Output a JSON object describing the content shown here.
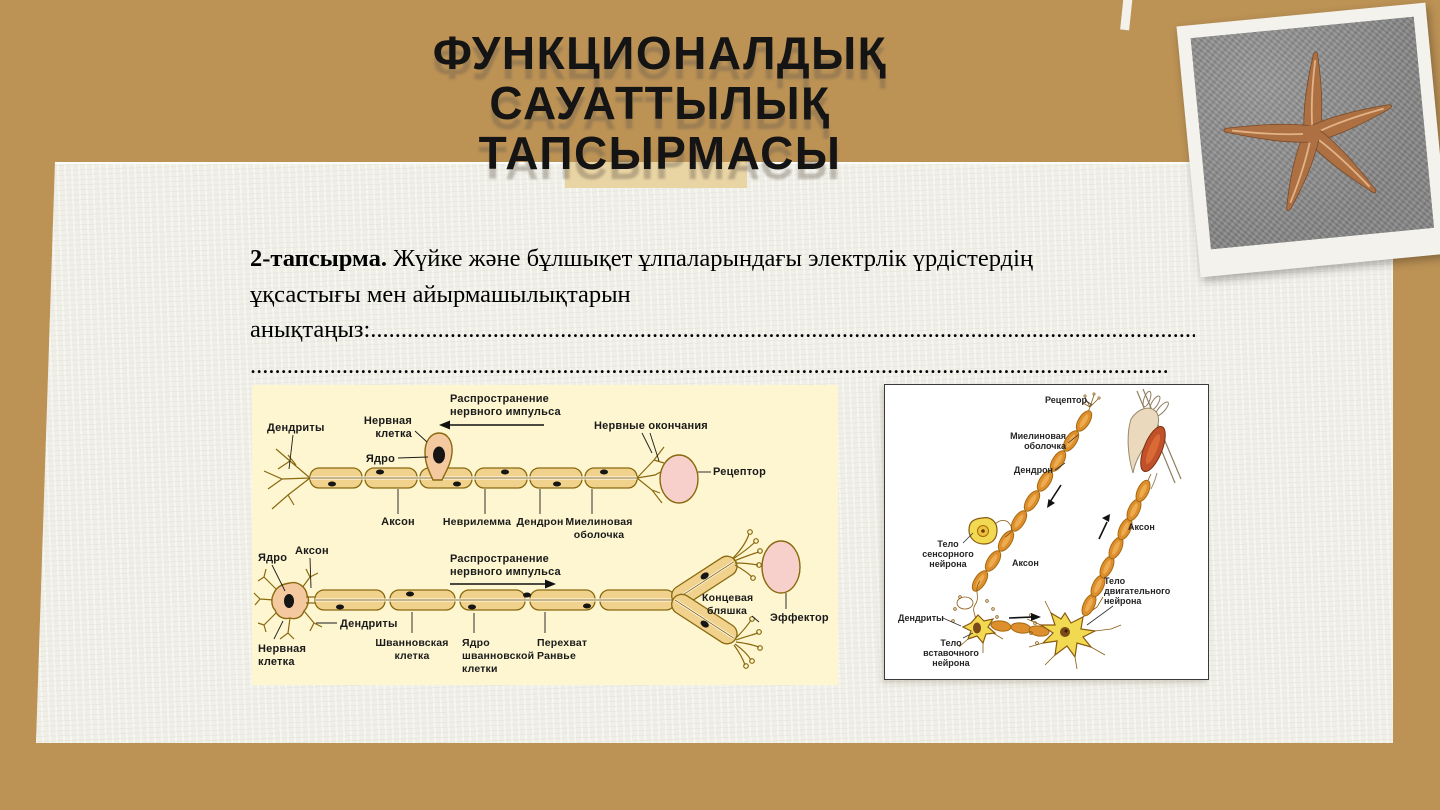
{
  "slide": {
    "title_lines": [
      "ФУНКЦИОНАЛДЫҚ",
      "САУАТТЫЛЫҚ",
      "ТАПСЫРМАСЫ"
    ],
    "task": {
      "number_label": "2-тапсырма.",
      "line1_rest": " Жүйке және бұлшықет ұлпаларындағы  электрлік үрдістердің",
      "line2": "ұқсастығы мен айырмашылықтарын",
      "line3_prefix": "анықтаңыз:",
      "line3_dots": "......................................................................................................................................................",
      "line4_dots": "................................................................................................................................................................"
    }
  },
  "neuron_diagram": {
    "impulse_label": [
      "Распространение",
      "нервного импульса"
    ],
    "top": {
      "dendrites": "Дендриты",
      "nerve_cell": [
        "Нервная",
        "клетка"
      ],
      "nucleus": "Ядро",
      "nerve_endings": "Нервные окончания",
      "receptor": "Рецептор",
      "axon": "Аксон",
      "neurilemma": "Неврилемма",
      "dendron": "Дендрон",
      "myelin_sheath": [
        "Миелиновая",
        "оболочка"
      ]
    },
    "bottom": {
      "nucleus": "Ядро",
      "axon": "Аксон",
      "dendrites": "Дендриты",
      "nerve_cell": [
        "Нервная",
        "клетка"
      ],
      "schwann_cell": [
        "Шванновская",
        "клетка"
      ],
      "schwann_nucleus": [
        "Ядро",
        "шванновской",
        "клетки"
      ],
      "node_of_ranvier": [
        "Перехват",
        "Ранвье"
      ],
      "end_plate": [
        "Концевая",
        "бляшка"
      ],
      "effector": "Эффектор"
    }
  },
  "reflex_diagram": {
    "receptor": "Рецептор",
    "myelin_sheath": [
      "Миелиновая",
      "оболочка"
    ],
    "dendron": "Дендрон",
    "sensory_neuron_body": [
      "Тело",
      "сенсорного",
      "нейрона"
    ],
    "axon_left": "Аксон",
    "axon_right": "Аксон",
    "motor_neuron_body": [
      "Тело",
      "двигательного",
      "нейрона"
    ],
    "dendrites": "Дендриты",
    "interneuron_body": [
      "Тело",
      "вставочного",
      "нейрона"
    ]
  },
  "colors": {
    "slide_background": "#bc9255",
    "paper": "#f1f1ea",
    "accent_strip": "#e9d4a4",
    "title_text": "#141414",
    "diagram_background": "#fdf6d0",
    "fiber_fill": "#f1d28c",
    "fiber_outline": "#8a690f",
    "cell_body_fill": "#f5c9a0",
    "receptor_pink": "#f7cfcb",
    "bead_orange": "#dd8f2e",
    "soma_yellow": "#f2d952",
    "muscle_red": "#c0512a"
  }
}
